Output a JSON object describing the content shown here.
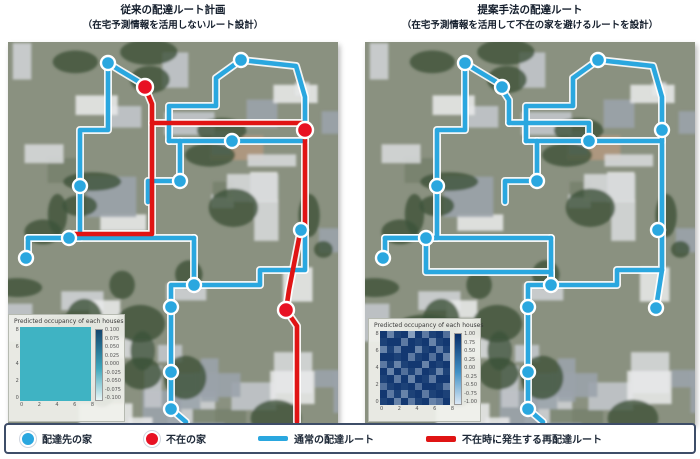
{
  "left_panel": {
    "title_line1": "従来の配達ルート計画",
    "title_line2": "（在宅予測情報を活用しないルート設計）"
  },
  "right_panel": {
    "title_line1": "提案手法の配達ルート",
    "title_line2": "（在宅予測情報を活用して不在の家を避けるルートを設計）"
  },
  "legend": {
    "items": [
      {
        "marker": "blue-dot",
        "label": "配達先の家"
      },
      {
        "marker": "red-dot",
        "label": "不在の家"
      },
      {
        "marker": "blue-line",
        "label": "通常の配達ルート"
      },
      {
        "marker": "red-line",
        "label": "不在時に発生する再配達ルート"
      }
    ]
  },
  "colors": {
    "route_blue": "#2aa7df",
    "route_red": "#e01414",
    "node_blue": "#2aa7df",
    "node_red": "#e81123",
    "legend_border": "#3e4d68",
    "inset_uniform_teal": "#3fb3c3"
  },
  "maps": {
    "left": {
      "nodes_blue": [
        [
          100,
          21
        ],
        [
          233,
          18
        ],
        [
          224,
          99
        ],
        [
          172,
          139
        ],
        [
          72,
          144
        ],
        [
          61,
          196
        ],
        [
          18,
          216
        ],
        [
          186,
          243
        ],
        [
          163,
          265
        ],
        [
          293,
          188
        ],
        [
          163,
          330
        ],
        [
          163,
          367
        ]
      ],
      "nodes_red": [
        [
          137,
          45
        ],
        [
          297,
          88
        ],
        [
          278,
          268
        ]
      ],
      "routes_blue": [
        [
          [
            100,
            21
          ],
          [
            113,
            29
          ],
          [
            133,
            41
          ]
        ],
        [
          [
            100,
            21
          ],
          [
            100,
            88
          ],
          [
            72,
            88
          ],
          [
            72,
            196
          ],
          [
            20,
            196
          ],
          [
            20,
            216
          ]
        ],
        [
          [
            233,
            18
          ],
          [
            288,
            24
          ],
          [
            297,
            55
          ],
          [
            297,
            88
          ]
        ],
        [
          [
            233,
            18
          ],
          [
            208,
            36
          ],
          [
            208,
            64
          ],
          [
            161,
            64
          ],
          [
            161,
            99
          ]
        ],
        [
          [
            161,
            99
          ],
          [
            297,
            99
          ]
        ],
        [
          [
            20,
            196
          ],
          [
            186,
            196
          ]
        ],
        [
          [
            172,
            99
          ],
          [
            172,
            139
          ],
          [
            140,
            139
          ],
          [
            140,
            160
          ]
        ],
        [
          [
            186,
            196
          ],
          [
            186,
            243
          ],
          [
            163,
            243
          ],
          [
            163,
            367
          ],
          [
            178,
            380
          ]
        ],
        [
          [
            186,
            243
          ],
          [
            252,
            243
          ],
          [
            252,
            228
          ],
          [
            297,
            228
          ],
          [
            297,
            190
          ]
        ]
      ],
      "routes_red": [
        [
          [
            137,
            45
          ],
          [
            144,
            62
          ],
          [
            144,
            81
          ]
        ],
        [
          [
            144,
            81
          ],
          [
            295,
            81
          ],
          [
            297,
            88
          ]
        ],
        [
          [
            144,
            81
          ],
          [
            144,
            192
          ],
          [
            66,
            192
          ]
        ],
        [
          [
            297,
            88
          ],
          [
            297,
            186
          ]
        ],
        [
          [
            293,
            186
          ],
          [
            281,
            248
          ],
          [
            278,
            268
          ]
        ],
        [
          [
            278,
            268
          ],
          [
            289,
            284
          ],
          [
            289,
            380
          ]
        ]
      ]
    },
    "right": {
      "nodes_blue": [
        [
          100,
          21
        ],
        [
          233,
          18
        ],
        [
          224,
          99
        ],
        [
          172,
          139
        ],
        [
          72,
          144
        ],
        [
          61,
          196
        ],
        [
          18,
          216
        ],
        [
          186,
          243
        ],
        [
          163,
          265
        ],
        [
          293,
          188
        ],
        [
          163,
          330
        ],
        [
          163,
          367
        ],
        [
          137,
          45
        ],
        [
          297,
          88
        ],
        [
          291,
          266
        ]
      ],
      "nodes_red": [],
      "routes_blue": [
        [
          [
            100,
            21
          ],
          [
            113,
            29
          ],
          [
            133,
            41
          ]
        ],
        [
          [
            100,
            21
          ],
          [
            100,
            88
          ],
          [
            72,
            88
          ],
          [
            72,
            196
          ],
          [
            20,
            196
          ],
          [
            20,
            216
          ]
        ],
        [
          [
            233,
            18
          ],
          [
            288,
            24
          ],
          [
            297,
            55
          ],
          [
            297,
            88
          ]
        ],
        [
          [
            233,
            18
          ],
          [
            208,
            36
          ],
          [
            208,
            64
          ],
          [
            161,
            64
          ],
          [
            161,
            99
          ]
        ],
        [
          [
            161,
            99
          ],
          [
            297,
            99
          ]
        ],
        [
          [
            20,
            196
          ],
          [
            186,
            196
          ]
        ],
        [
          [
            172,
            99
          ],
          [
            172,
            139
          ],
          [
            140,
            139
          ],
          [
            140,
            160
          ]
        ],
        [
          [
            186,
            196
          ],
          [
            186,
            243
          ],
          [
            163,
            243
          ],
          [
            163,
            367
          ],
          [
            178,
            380
          ]
        ],
        [
          [
            186,
            243
          ],
          [
            252,
            243
          ],
          [
            252,
            228
          ],
          [
            297,
            228
          ],
          [
            297,
            190
          ]
        ],
        [
          [
            133,
            41
          ],
          [
            144,
            58
          ],
          [
            144,
            81
          ]
        ],
        [
          [
            144,
            81
          ],
          [
            224,
            81
          ],
          [
            224,
            99
          ]
        ],
        [
          [
            297,
            88
          ],
          [
            297,
            190
          ]
        ],
        [
          [
            297,
            228
          ],
          [
            291,
            266
          ]
        ],
        [
          [
            61,
            196
          ],
          [
            61,
            230
          ],
          [
            186,
            230
          ],
          [
            186,
            243
          ]
        ]
      ],
      "routes_red": []
    }
  },
  "chart_data": [
    {
      "type": "heatmap",
      "panel": "left",
      "title": "Predicted occupancy of each houses",
      "x_ticks": [
        "0",
        "2",
        "4",
        "6",
        "8"
      ],
      "y_ticks": [
        "8",
        "6",
        "4",
        "2",
        "0"
      ],
      "colorbar_ticks": [
        "0.100",
        "0.075",
        "0.050",
        "0.025",
        "0.000",
        "-0.025",
        "-0.050",
        "-0.075",
        "-0.100"
      ],
      "value_range": [
        -0.1,
        0.1
      ],
      "uniform_value": 0.0
    },
    {
      "type": "heatmap",
      "panel": "right",
      "title": "Predicted occupancy of each houses",
      "x_ticks": [
        "0",
        "2",
        "4",
        "6",
        "8"
      ],
      "y_ticks": [
        "8",
        "6",
        "4",
        "2",
        "0"
      ],
      "colorbar_ticks": [
        "1.00",
        "0.75",
        "0.50",
        "0.25",
        "0.00",
        "-0.25",
        "-0.50",
        "-0.75",
        "-1.00"
      ],
      "value_range": [
        -1.0,
        1.0
      ],
      "values": [
        [
          0.9,
          0.1,
          0.8,
          0.9,
          -0.2,
          0.9,
          0.2,
          0.8,
          0.9,
          0.3
        ],
        [
          0.8,
          0.9,
          0.9,
          0.2,
          0.9,
          0.8,
          0.9,
          0.1,
          0.8,
          0.9
        ],
        [
          0.1,
          0.8,
          0.2,
          0.9,
          0.9,
          0.1,
          0.8,
          0.9,
          0.2,
          0.8
        ],
        [
          0.9,
          0.9,
          0.8,
          0.9,
          0.2,
          0.8,
          0.9,
          0.3,
          0.9,
          0.1
        ],
        [
          0.2,
          0.8,
          0.1,
          0.8,
          0.9,
          0.9,
          0.1,
          0.9,
          0.8,
          0.9
        ],
        [
          0.9,
          0.1,
          0.9,
          0.3,
          0.8,
          0.2,
          0.9,
          0.8,
          0.1,
          0.8
        ],
        [
          0.8,
          0.9,
          0.2,
          0.9,
          0.1,
          0.9,
          0.8,
          0.2,
          0.9,
          0.9
        ],
        [
          0.3,
          0.8,
          0.9,
          0.8,
          0.9,
          0.3,
          0.9,
          0.9,
          0.8,
          0.2
        ],
        [
          0.9,
          0.2,
          0.8,
          0.1,
          0.8,
          0.9,
          0.2,
          0.8,
          0.9,
          0.8
        ],
        [
          0.8,
          0.9,
          0.1,
          0.9,
          0.2,
          0.8,
          0.9,
          0.1,
          0.3,
          0.9
        ]
      ]
    }
  ]
}
